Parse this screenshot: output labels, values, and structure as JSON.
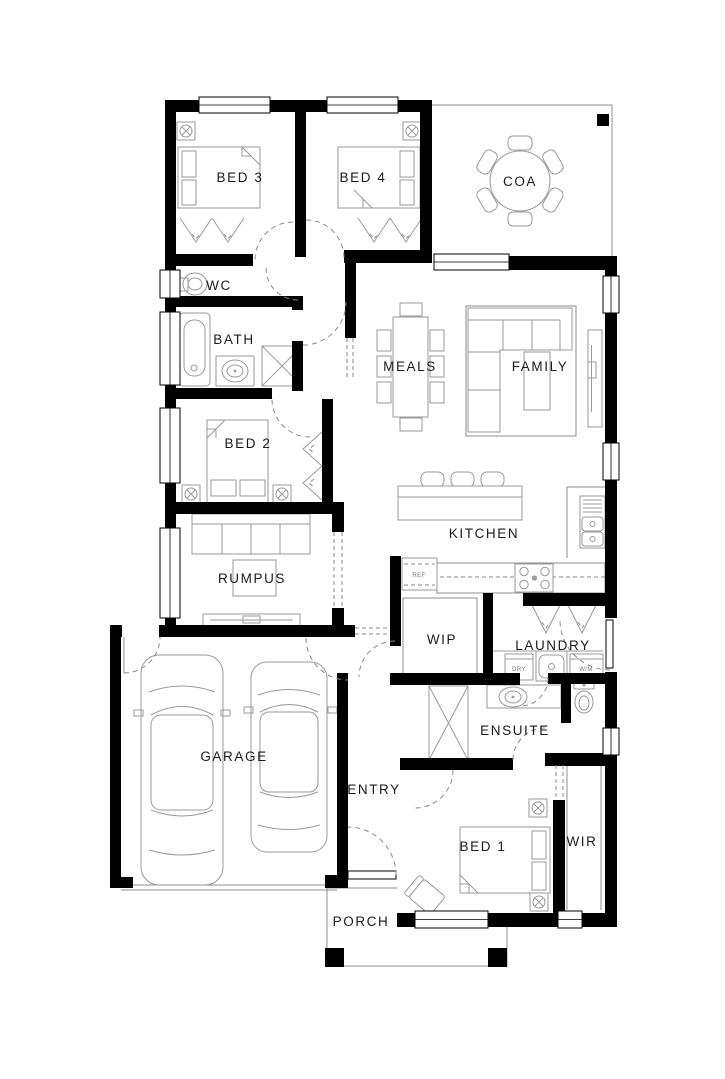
{
  "plan": {
    "title": "single-storey house floor plan",
    "rooms": {
      "bed3": "BED 3",
      "bed4": "BED 4",
      "coa": "COA",
      "wc": "WC",
      "bath": "BATH",
      "meals": "MEALS",
      "family": "FAMILY",
      "bed2": "BED 2",
      "kitchen": "KITCHEN",
      "rumpus": "RUMPUS",
      "wip": "WIP",
      "laundry": "LAUNDRY",
      "ensuite": "ENSUITE",
      "garage": "GARAGE",
      "entry": "ENTRY",
      "bed1": "BED 1",
      "wir": "WIR",
      "porch": "PORCH"
    },
    "appliances": {
      "fridge": "REF",
      "dryer": "DRY",
      "washer": "W/M"
    },
    "colors": {
      "wall": "#000000",
      "furniture": "#9a9a9a",
      "background": "#ffffff",
      "label": "#1c1c1c"
    }
  }
}
